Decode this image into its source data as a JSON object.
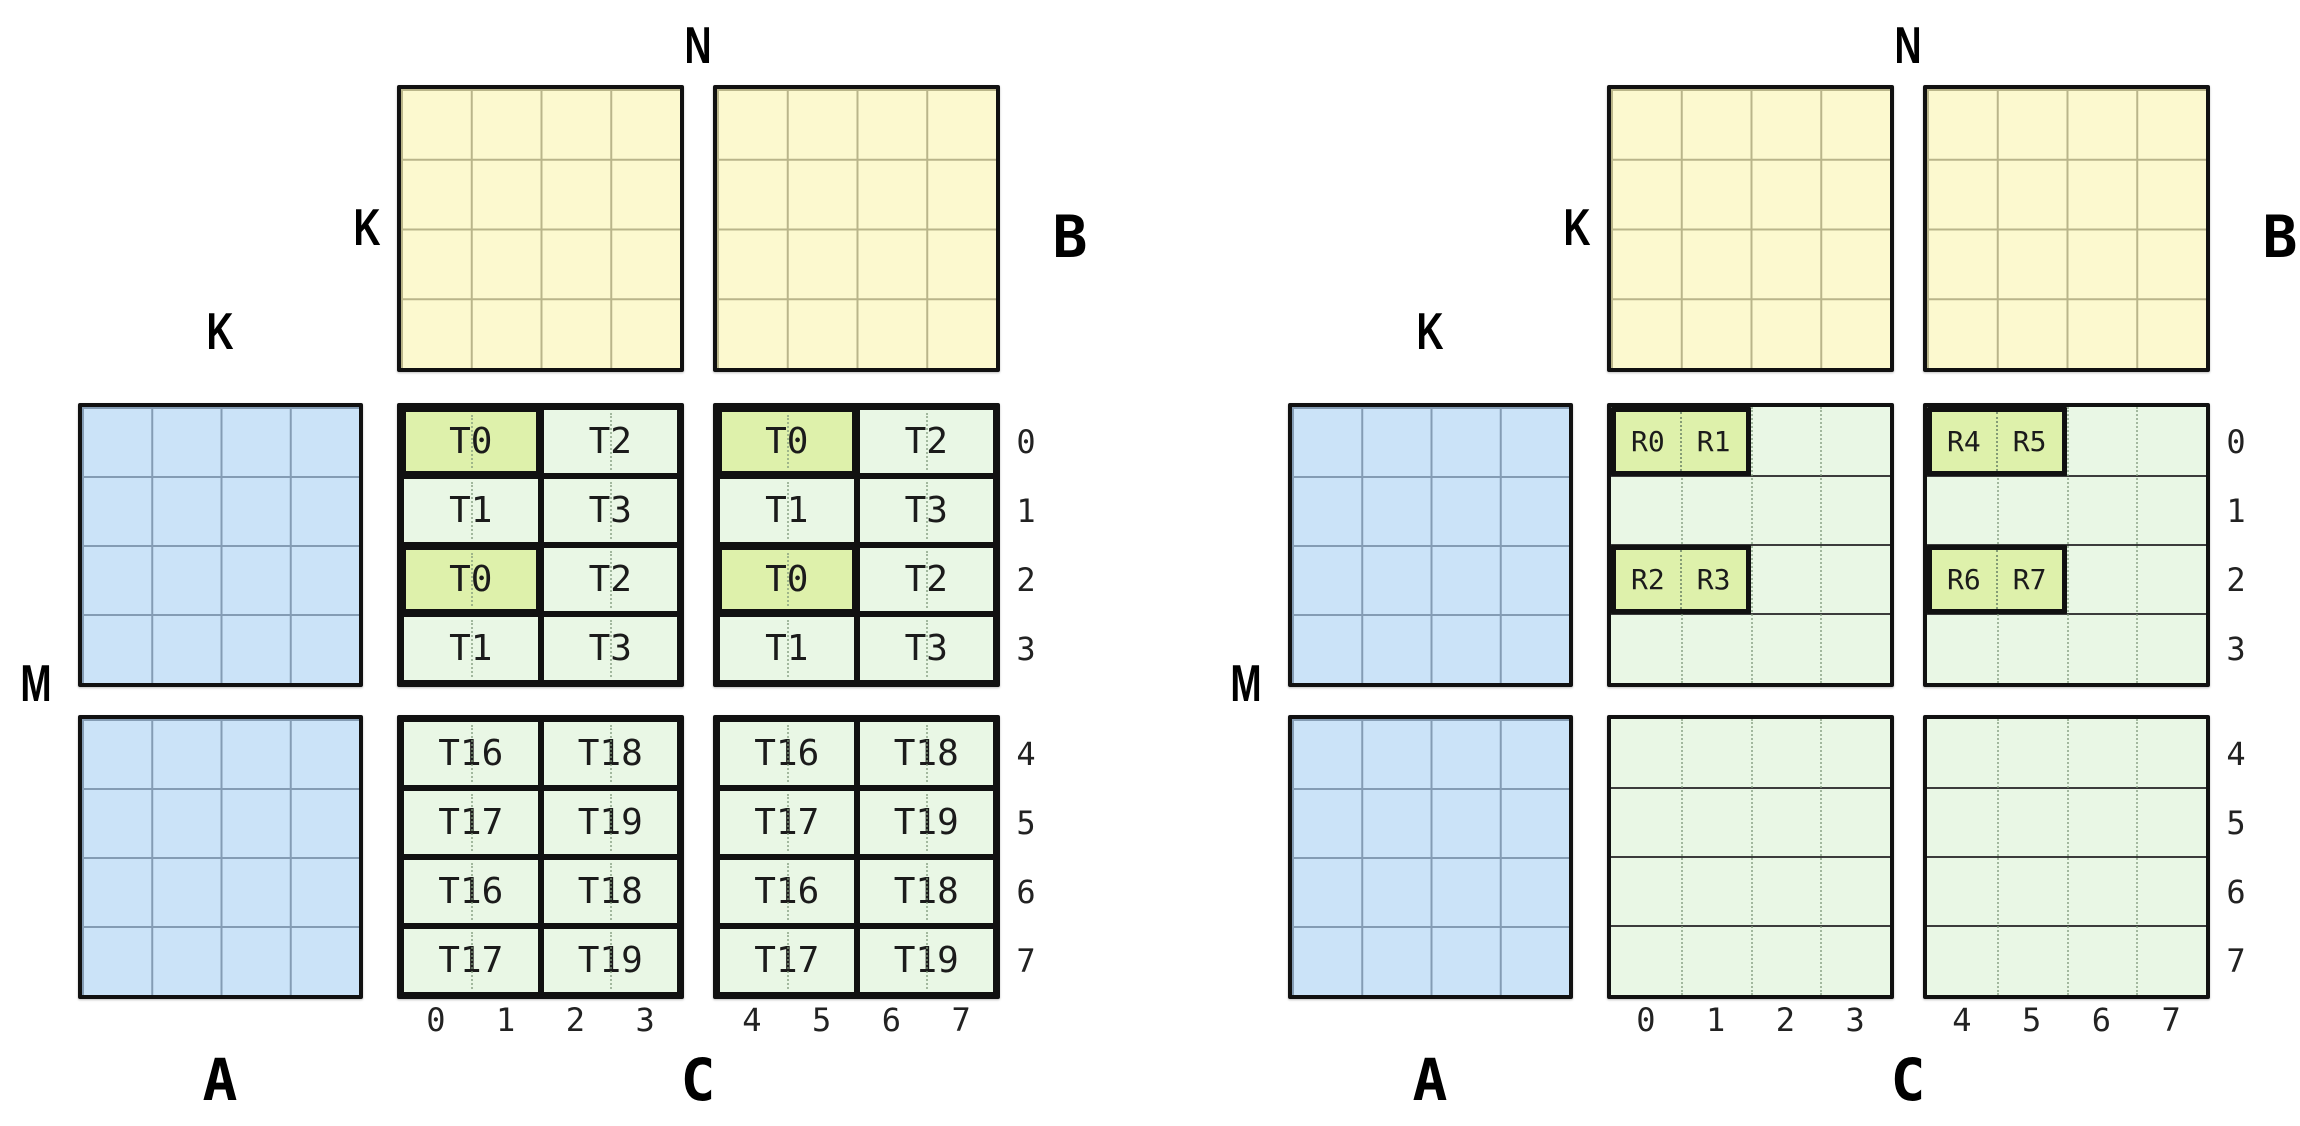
{
  "colors": {
    "matrix_a_fill": "#cbe3f8",
    "matrix_a_grid": "#849cb4",
    "matrix_b_fill": "#fcf9cf",
    "matrix_b_grid": "#b9b58a",
    "matrix_c_fill": "#e9f7e5",
    "highlight_fill": "#def1ab",
    "outline": "#111111"
  },
  "diagrams": [
    {
      "name": "thread-tiles",
      "axis_labels": {
        "n": "N",
        "k_left_of_b": "K",
        "k_above_a": "K",
        "m": "M"
      },
      "matrix_labels": {
        "a": "A",
        "b": "B",
        "c": "C"
      },
      "row_indices": [
        "0",
        "1",
        "2",
        "3",
        "4",
        "5",
        "6",
        "7"
      ],
      "col_indices": [
        "0",
        "1",
        "2",
        "3",
        "4",
        "5",
        "6",
        "7"
      ],
      "c_style": "thread-cells",
      "c_bands": [
        {
          "blocks": [
            {
              "cell_labels": [
                [
                  "T0",
                  "T2"
                ],
                [
                  "T1",
                  "T3"
                ],
                [
                  "T0",
                  "T2"
                ],
                [
                  "T1",
                  "T3"
                ]
              ],
              "highlighted": [
                [
                  true,
                  false
                ],
                [
                  false,
                  false
                ],
                [
                  true,
                  false
                ],
                [
                  false,
                  false
                ]
              ]
            },
            {
              "cell_labels": [
                [
                  "T0",
                  "T2"
                ],
                [
                  "T1",
                  "T3"
                ],
                [
                  "T0",
                  "T2"
                ],
                [
                  "T1",
                  "T3"
                ]
              ],
              "highlighted": [
                [
                  true,
                  false
                ],
                [
                  false,
                  false
                ],
                [
                  true,
                  false
                ],
                [
                  false,
                  false
                ]
              ]
            }
          ]
        },
        {
          "blocks": [
            {
              "cell_labels": [
                [
                  "T16",
                  "T18"
                ],
                [
                  "T17",
                  "T19"
                ],
                [
                  "T16",
                  "T18"
                ],
                [
                  "T17",
                  "T19"
                ]
              ],
              "highlighted": [
                [
                  false,
                  false
                ],
                [
                  false,
                  false
                ],
                [
                  false,
                  false
                ],
                [
                  false,
                  false
                ]
              ]
            },
            {
              "cell_labels": [
                [
                  "T16",
                  "T18"
                ],
                [
                  "T17",
                  "T19"
                ],
                [
                  "T16",
                  "T18"
                ],
                [
                  "T17",
                  "T19"
                ]
              ],
              "highlighted": [
                [
                  false,
                  false
                ],
                [
                  false,
                  false
                ],
                [
                  false,
                  false
                ],
                [
                  false,
                  false
                ]
              ]
            }
          ]
        }
      ]
    },
    {
      "name": "register-tiles",
      "axis_labels": {
        "n": "N",
        "k_left_of_b": "K",
        "k_above_a": "K",
        "m": "M"
      },
      "matrix_labels": {
        "a": "A",
        "b": "B",
        "c": "C"
      },
      "row_indices": [
        "0",
        "1",
        "2",
        "3",
        "4",
        "5",
        "6",
        "7"
      ],
      "col_indices": [
        "0",
        "1",
        "2",
        "3",
        "4",
        "5",
        "6",
        "7"
      ],
      "c_style": "register-grid",
      "r_groups": [
        {
          "band": 0,
          "block": 0,
          "row": 0,
          "labels": [
            "R0",
            "R1"
          ]
        },
        {
          "band": 0,
          "block": 0,
          "row": 2,
          "labels": [
            "R2",
            "R3"
          ]
        },
        {
          "band": 0,
          "block": 1,
          "row": 0,
          "labels": [
            "R4",
            "R5"
          ]
        },
        {
          "band": 0,
          "block": 1,
          "row": 2,
          "labels": [
            "R6",
            "R7"
          ]
        }
      ]
    }
  ]
}
